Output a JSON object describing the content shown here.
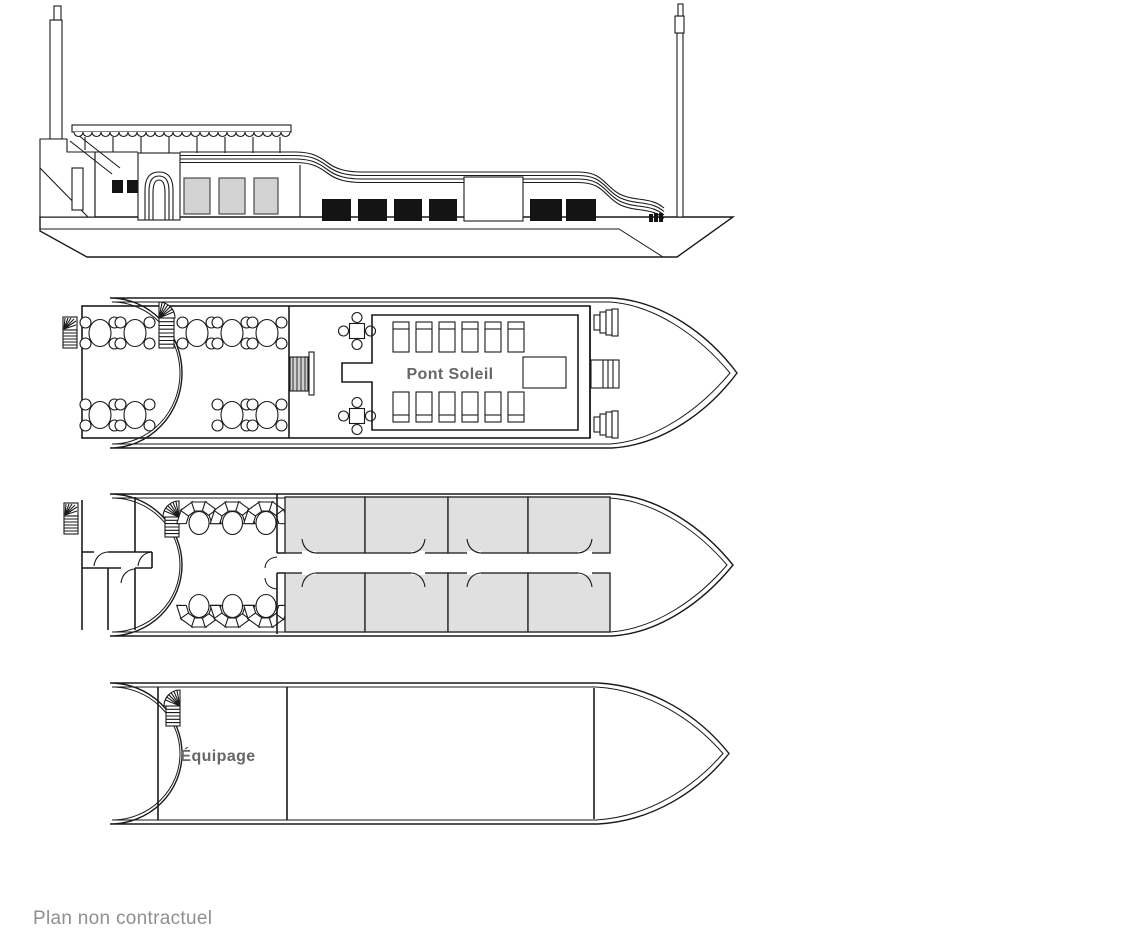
{
  "labels": {
    "sun_deck": "Pont Soleil",
    "crew_deck": "Équipage",
    "footnote": "Plan non contractuel"
  },
  "colors": {
    "background": "#ffffff",
    "outline": "#1a1a1a",
    "cabin_fill": "#e0e0e0",
    "window_gray": "#d2d2d2",
    "window_black": "#141414",
    "deck_label_text": "#666666",
    "footnote_text": "#8f8f8f"
  }
}
